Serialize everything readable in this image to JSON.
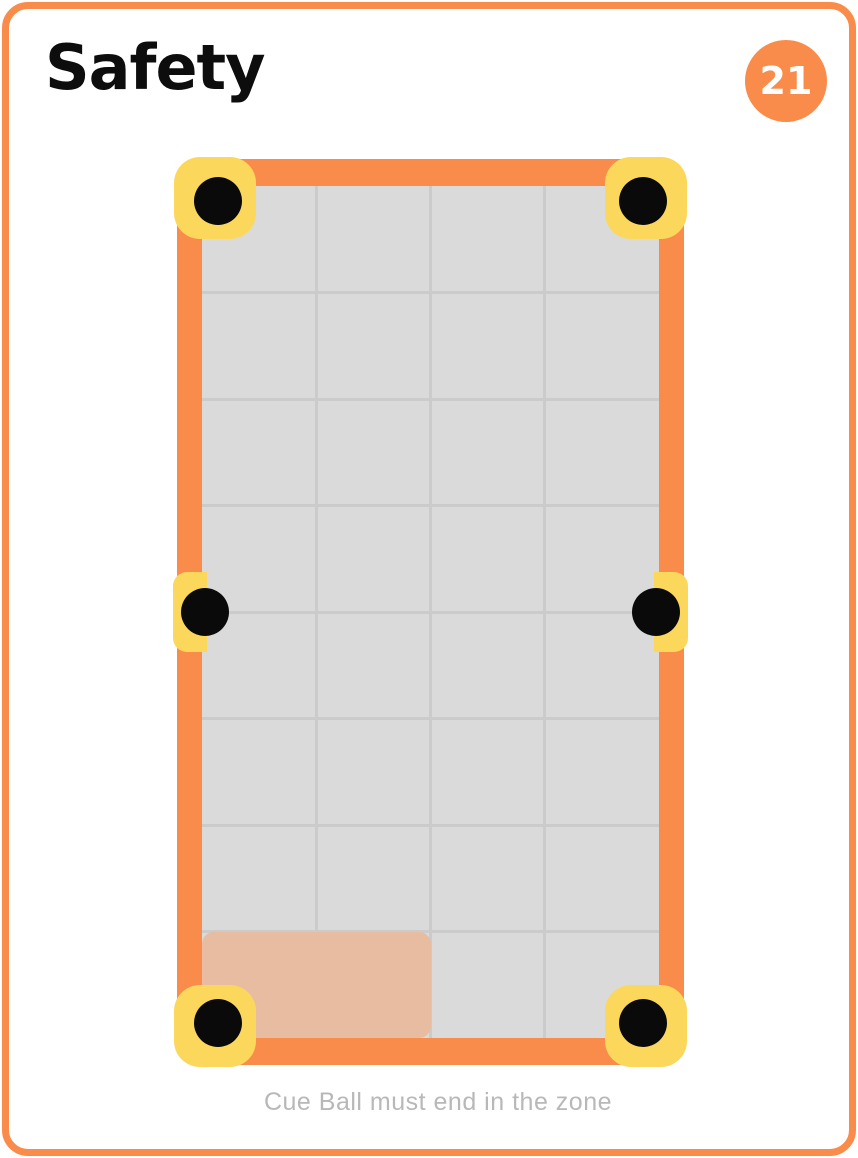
{
  "card": {
    "title": "Safety",
    "badge": "21",
    "caption": "Cue Ball must end in the zone"
  },
  "colors": {
    "card_bg": "#ffffff",
    "orange": "#F98C4A",
    "yellow": "#FBD85C",
    "felt": "#DADADA",
    "grid_line": "#CBCBCB",
    "zone": "#E8BCA0",
    "pocket": "#0A0A0A",
    "title_text": "#0D0D0D",
    "caption_text": "#B8B8B8"
  },
  "table": {
    "grid": {
      "cols": 4,
      "rows": 8
    },
    "zone": {
      "anchor": "bottom-left",
      "cols": 2,
      "rows": 1
    },
    "pockets": [
      {
        "position": "top-left"
      },
      {
        "position": "top-right"
      },
      {
        "position": "middle-left"
      },
      {
        "position": "middle-right"
      },
      {
        "position": "bottom-left"
      },
      {
        "position": "bottom-right"
      }
    ]
  }
}
